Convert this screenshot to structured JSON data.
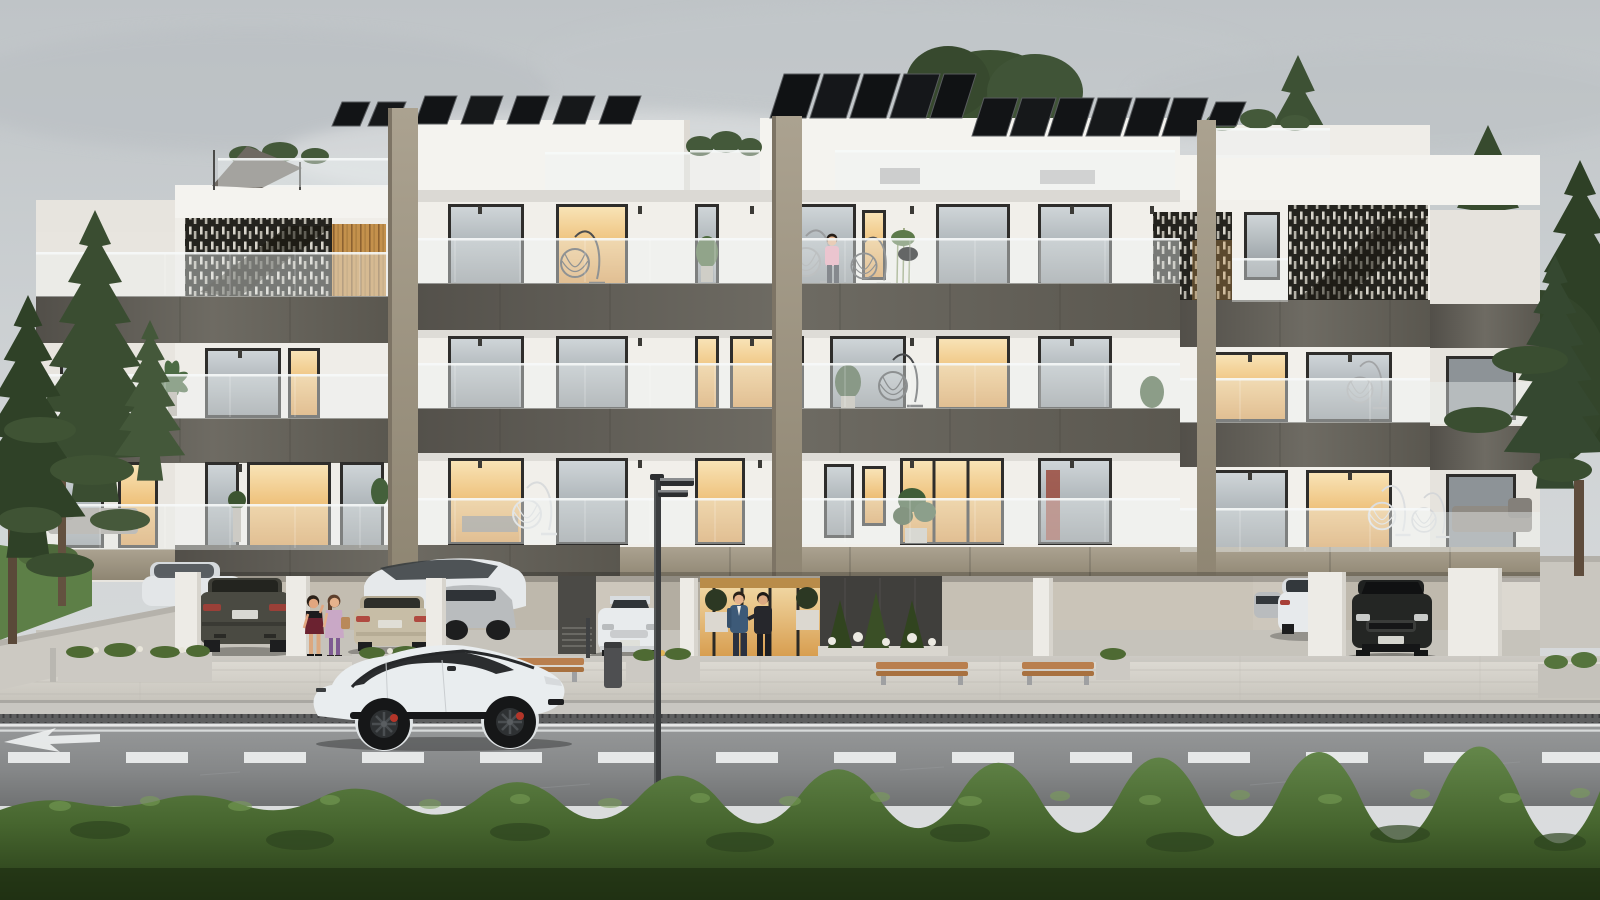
{
  "scene": {
    "description": "Photorealistic architectural rendering of a modern three-storey apartment building with rooftop solar panels, glass balcony balustrades, dark lattice screens, ground-level open parking, people at the entrance, a white sports sedan on the street, conifer trees on both sides and a trimmed green hedge in the foreground under an overcast sky",
    "sky": "overcast light gray with soft cloud bands",
    "vegetation": [
      "tall conifer trees left of building",
      "conifer tree cluster right of building",
      "tree canopy behind rooftop",
      "green trimmed hedge across foreground",
      "lawn strip at far left",
      "balcony potted plants",
      "garden bed with small conifers and white flowers"
    ],
    "building": {
      "storeys_visible": 3,
      "roof": [
        "four tilted solar-panel arrays",
        "set-back penthouse volumes",
        "roof terrace with glass railing and shrubs",
        "triangular shade sail on left roof terrace"
      ],
      "facade": [
        "white rendered walls",
        "dark gray stone balcony fascia bands",
        "khaki accent pilasters",
        "continuous glass balustrades",
        "dark perforated lattice screens with staircase silhouette",
        "warm wood slat panel",
        "recessed soffit downlights"
      ],
      "windows": "dark-framed floor-to-ceiling glazing, several glowing warm amber",
      "ground_level": [
        "open parking deck with white pillars",
        "warm lit glazed entrance lobby",
        "dark feature stone wall",
        "louvered utility wall",
        "ball topiary planters at entrance"
      ]
    },
    "vehicles": [
      {
        "label": "white electric sports sedan driving on road"
      },
      {
        "label": "dark olive sedan parked rear view"
      },
      {
        "label": "white car parked in background"
      },
      {
        "label": "white sedan parked three-quarter view"
      },
      {
        "label": "champagne sedan parked rear view"
      },
      {
        "label": "silver car parked side sliver"
      },
      {
        "label": "white compact car parked front view"
      },
      {
        "label": "white SUV parked rear-quarter view"
      },
      {
        "label": "black sedan parked front view"
      }
    ],
    "people": [
      {
        "label": "woman in dark red mini dress near parked cars"
      },
      {
        "label": "woman in lavender dress with handbag"
      },
      {
        "label": "man in blue suit at entrance"
      },
      {
        "label": "man in dark suit at entrance"
      },
      {
        "label": "man in pink shirt on top-floor balcony"
      }
    ],
    "street_furniture": [
      "steel street lamp with twin luminaires",
      "three wooden benches",
      "litter bin",
      "concrete flower planters",
      "curb drainage grate",
      "double white edge lines",
      "dashed white center line",
      "white merge arrow marking",
      "small signal post",
      "hanging egg chairs on balconies"
    ]
  },
  "palette": {
    "white_hi": "#f4f3ef",
    "white_mid": "#efede8",
    "white_shade": "#e7e4de",
    "frame": "#2e2d2b",
    "marking": "#eef0f0",
    "band": "#5d5a53",
    "khaki": "#9d9482",
    "tree_dark": "#36482d",
    "tree_mid": "#42563a",
    "tree_light": "#5a7048",
    "trunk": "#5a4939",
    "grass": "#5d7f47",
    "hedge_hi": "#739952",
    "hedge_mid": "#47662f",
    "hedge_dark": "#263a17",
    "road": "#8a8c8d",
    "pave": "#d5d2cb",
    "lamp": "#3a3c3e",
    "car_white": "#e9edef",
    "car_black": "#242624",
    "car_olive": "#4a4a42",
    "car_beige": "#c7bda6",
    "car_silver": "#b9bcbe",
    "lattice": "#24231e",
    "wood": "#c4914c",
    "warm": "#eec079",
    "solar": "#121416",
    "glassrail": "#eef2f4",
    "stone_wall": "#403f3c",
    "lobby": "#eccf96",
    "skin": "#e5b28c",
    "suit_blue": "#3d5a78",
    "suit_dark": "#26272c",
    "dress_red": "#6b2230",
    "dress_lavender": "#c9a8c6",
    "shirt_pink": "#e8a4b6"
  }
}
